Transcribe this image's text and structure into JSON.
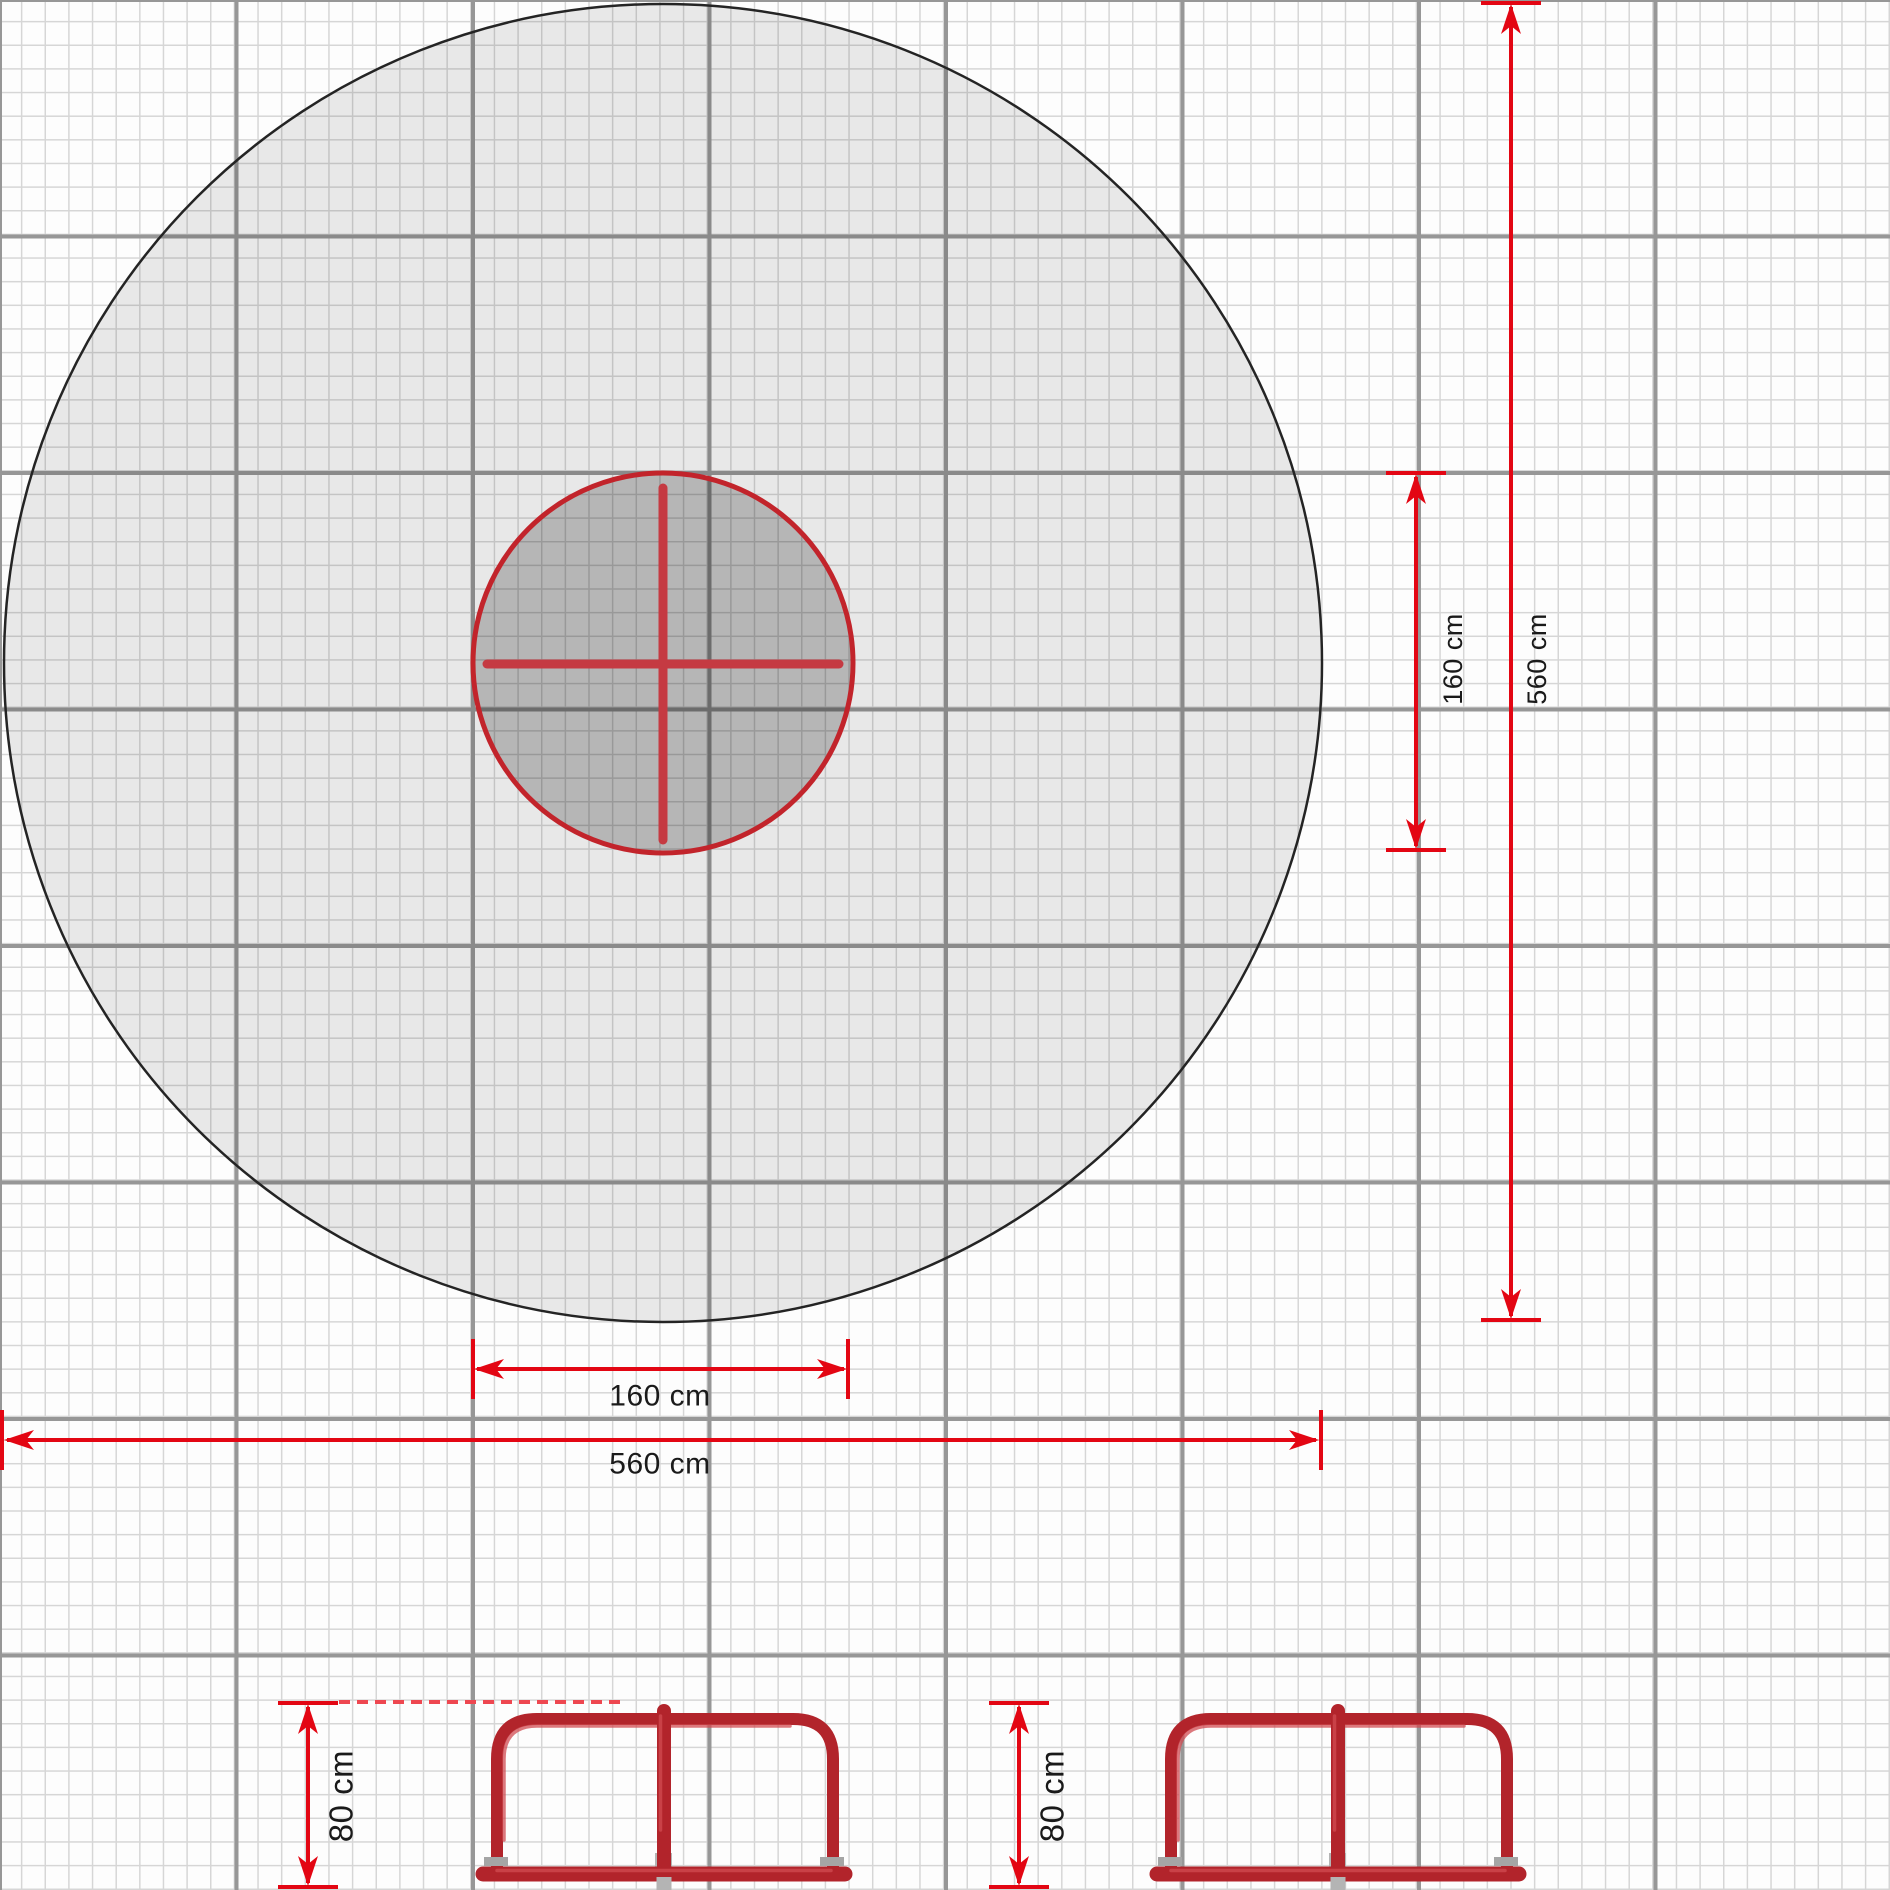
{
  "colors": {
    "paper": "#fdfdfd",
    "grid_minor": "#d6d6d6",
    "grid_major": "#979797",
    "zone_outline": "#242424",
    "zone_fill": "rgba(0,0,0,0.082)",
    "platform_fill": "rgba(0,0,0,0.215)",
    "platform_outline": "#c2242b",
    "cross_red": "#c53a42",
    "dimension_red": "#e30613",
    "dash_red": "#ee4750",
    "structure_red": "#b2242b",
    "structure_highlight": "#d04b52",
    "metal_gray": "#b4b4b4",
    "metal_dark": "#a5a5a5",
    "text_dark": "#1a1a1a"
  },
  "plan_view": {
    "platform_dim_vertical": "160 cm",
    "zone_dim_vertical": "560 cm",
    "platform_dim_horizontal": "160 cm",
    "zone_dim_horizontal": "560 cm"
  },
  "side_view_left": {
    "height_dim": "80 cm"
  },
  "side_view_right": {
    "height_dim": "80 cm"
  }
}
